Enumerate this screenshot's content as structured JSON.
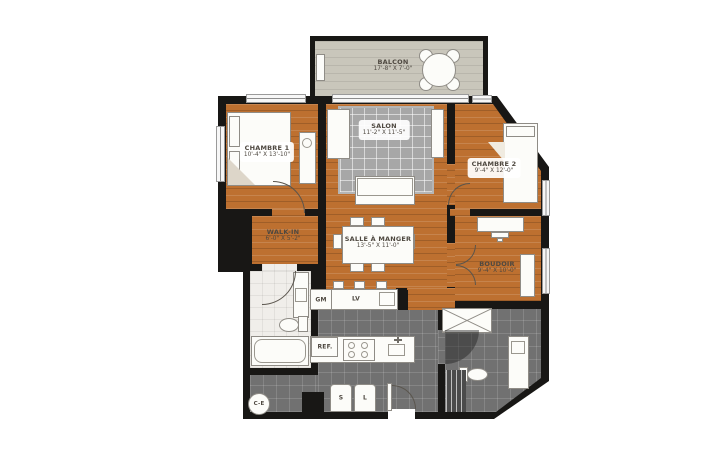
{
  "rooms": {
    "balcon": {
      "name": "BALCON",
      "dims": "17'-8\" X 7'-0\""
    },
    "chambre1": {
      "name": "CHAMBRE 1",
      "dims": "10'-4\" X 13'-10\""
    },
    "salon": {
      "name": "SALON",
      "dims": "11'-2\" X 11'-5\""
    },
    "chambre2": {
      "name": "CHAMBRE 2",
      "dims": "9'-4\" X 12'-0\""
    },
    "walkin": {
      "name": "WALK-IN",
      "dims": "6'-0\" X 5'-2\""
    },
    "salle": {
      "name": "SALLE À MANGER",
      "dims": "13'-5\" X 11'-0\""
    },
    "boudoir": {
      "name": "BOUDOIR",
      "dims": "9'-4\" X 10'-0\""
    }
  },
  "fixtures": {
    "pantry": "GM",
    "dishwasher": "LV",
    "fridge": "REF.",
    "dryer": "S",
    "washer": "L",
    "water_heater": "C-E"
  },
  "colors": {
    "wall": "#181715",
    "wood_floor": "#bd7030",
    "balcony_floor": "#c9c6bb",
    "tile_dark": "#717171",
    "tile_light": "#f0eeea",
    "rug": "#a7a7a7"
  }
}
